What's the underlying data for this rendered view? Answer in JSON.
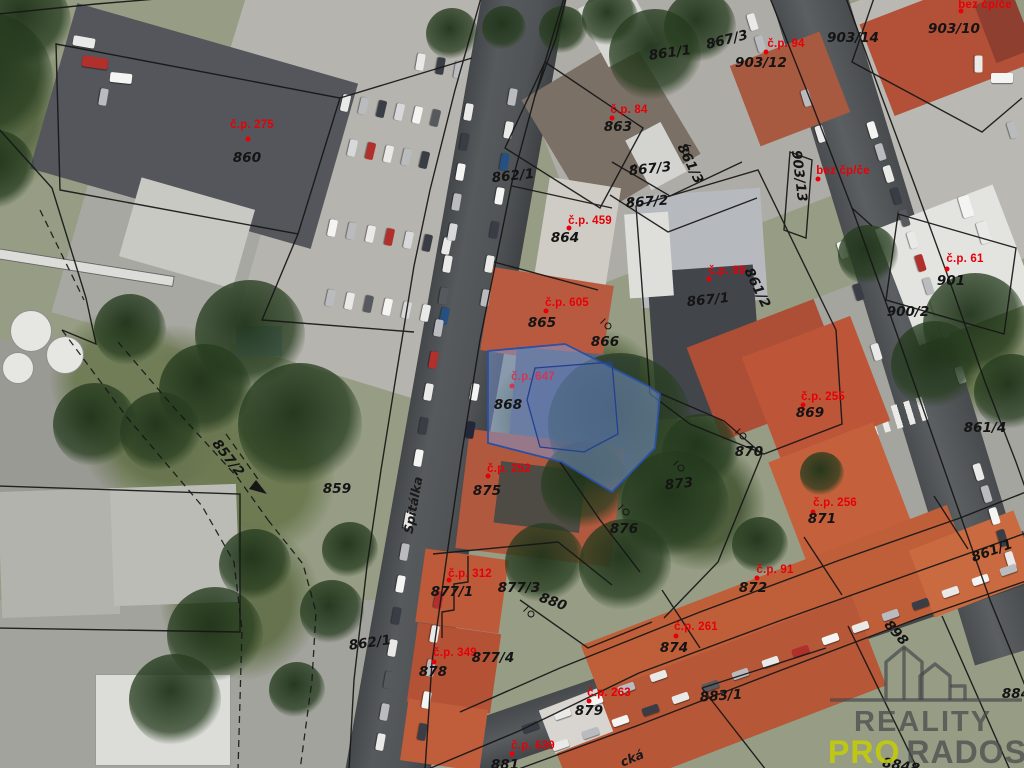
{
  "map": {
    "highlight": {
      "fill": "#7b97d3",
      "fill_opacity": 0.5,
      "stroke": "#2b50a5",
      "inner_fill": "#3c5cb0",
      "inner_fill_opacity": 0.18,
      "inner_stroke": "#23408f"
    },
    "colors": {
      "house_number_red": "#e60008",
      "parcel_black": "#141414",
      "highlight_label": "#cf3657"
    },
    "red_labels": [
      {
        "text": "č.p. 275",
        "x": 252,
        "y": 125,
        "dot_x": 248,
        "dot_y": 139
      },
      {
        "text": "č.p. 84",
        "x": 629,
        "y": 110,
        "dot_x": 612,
        "dot_y": 118
      },
      {
        "text": "č.p. 94",
        "x": 786,
        "y": 44,
        "dot_x": 766,
        "dot_y": 52
      },
      {
        "text": "bez čp/če",
        "x": 985,
        "y": 5,
        "dot_x": 961,
        "dot_y": 11
      },
      {
        "text": "bez čp/če",
        "x": 843,
        "y": 171,
        "dot_x": 818,
        "dot_y": 179
      },
      {
        "text": "č.p. 459",
        "x": 590,
        "y": 221,
        "dot_x": 569,
        "dot_y": 228
      },
      {
        "text": "č.p. 605",
        "x": 567,
        "y": 303,
        "dot_x": 546,
        "dot_y": 311
      },
      {
        "text": "č.p. 89",
        "x": 727,
        "y": 271,
        "dot_x": 709,
        "dot_y": 279
      },
      {
        "text": "č.p. 61",
        "x": 965,
        "y": 259,
        "dot_x": 947,
        "dot_y": 269
      },
      {
        "text": "č.p. 255",
        "x": 823,
        "y": 397,
        "dot_x": 803,
        "dot_y": 405
      },
      {
        "text": "č.p. 647",
        "x": 533,
        "y": 377,
        "dot_x": 512,
        "dot_y": 386,
        "color": "#cf3657"
      },
      {
        "text": "č.p. 252",
        "x": 509,
        "y": 469,
        "dot_x": 488,
        "dot_y": 476
      },
      {
        "text": "č.p. 256",
        "x": 835,
        "y": 503,
        "dot_x": 813,
        "dot_y": 512
      },
      {
        "text": "č.p. 312",
        "x": 470,
        "y": 574,
        "dot_x": 449,
        "dot_y": 580
      },
      {
        "text": "č.p. 91",
        "x": 775,
        "y": 570,
        "dot_x": 757,
        "dot_y": 578
      },
      {
        "text": "č.p. 261",
        "x": 696,
        "y": 627,
        "dot_x": 676,
        "dot_y": 636
      },
      {
        "text": "č.p. 349",
        "x": 455,
        "y": 653,
        "dot_x": 434,
        "dot_y": 662
      },
      {
        "text": "č.p. 263",
        "x": 609,
        "y": 693,
        "dot_x": 589,
        "dot_y": 701
      },
      {
        "text": "č.p. 639",
        "x": 533,
        "y": 746,
        "dot_x": 512,
        "dot_y": 754
      }
    ],
    "parcel_labels": [
      {
        "text": "860",
        "x": 247,
        "y": 158,
        "rot": 0
      },
      {
        "text": "861/1",
        "x": 670,
        "y": 53,
        "rot": -8
      },
      {
        "text": "903/12",
        "x": 761,
        "y": 63,
        "rot": 0
      },
      {
        "text": "903/14",
        "x": 853,
        "y": 38,
        "rot": 0
      },
      {
        "text": "903/10",
        "x": 954,
        "y": 29,
        "rot": 0
      },
      {
        "text": "862/1",
        "x": 513,
        "y": 176,
        "rot": -6
      },
      {
        "text": "863",
        "x": 618,
        "y": 127,
        "rot": 0
      },
      {
        "text": "867/3",
        "x": 727,
        "y": 40,
        "rot": -14
      },
      {
        "text": "867/3",
        "x": 650,
        "y": 169,
        "rot": -6
      },
      {
        "text": "867/2",
        "x": 647,
        "y": 202,
        "rot": -4
      },
      {
        "text": "864",
        "x": 565,
        "y": 238,
        "rot": 0
      },
      {
        "text": "865",
        "x": 542,
        "y": 323,
        "rot": 0
      },
      {
        "text": "866",
        "x": 605,
        "y": 342,
        "rot": 0
      },
      {
        "text": "861/3",
        "x": 690,
        "y": 164,
        "rot": 64
      },
      {
        "text": "861/2",
        "x": 757,
        "y": 288,
        "rot": 64
      },
      {
        "text": "867/1",
        "x": 708,
        "y": 300,
        "rot": -6
      },
      {
        "text": "901",
        "x": 951,
        "y": 281,
        "rot": 0
      },
      {
        "text": "900/2",
        "x": 908,
        "y": 312,
        "rot": 0
      },
      {
        "text": "903/13",
        "x": 799,
        "y": 176,
        "rot": 83
      },
      {
        "text": "869",
        "x": 810,
        "y": 413,
        "rot": 0
      },
      {
        "text": "859",
        "x": 337,
        "y": 489,
        "rot": 0
      },
      {
        "text": "857/2",
        "x": 228,
        "y": 458,
        "rot": 52
      },
      {
        "text": "868",
        "x": 508,
        "y": 405,
        "rot": 0
      },
      {
        "text": "870",
        "x": 749,
        "y": 452,
        "rot": 0
      },
      {
        "text": "873",
        "x": 679,
        "y": 484,
        "rot": -6
      },
      {
        "text": "875",
        "x": 487,
        "y": 491,
        "rot": 0
      },
      {
        "text": "876",
        "x": 624,
        "y": 529,
        "rot": 0
      },
      {
        "text": "871",
        "x": 822,
        "y": 519,
        "rot": 0
      },
      {
        "text": "861/4",
        "x": 985,
        "y": 428,
        "rot": 0
      },
      {
        "text": "861/1",
        "x": 992,
        "y": 551,
        "rot": -20
      },
      {
        "text": "872",
        "x": 753,
        "y": 588,
        "rot": 0
      },
      {
        "text": "874",
        "x": 674,
        "y": 648,
        "rot": 0
      },
      {
        "text": "877/1",
        "x": 452,
        "y": 592,
        "rot": 0
      },
      {
        "text": "877/3",
        "x": 519,
        "y": 588,
        "rot": 0
      },
      {
        "text": "880",
        "x": 553,
        "y": 602,
        "rot": 20
      },
      {
        "text": "877/4",
        "x": 493,
        "y": 658,
        "rot": 0
      },
      {
        "text": "878",
        "x": 433,
        "y": 672,
        "rot": 0
      },
      {
        "text": "879",
        "x": 589,
        "y": 711,
        "rot": 0
      },
      {
        "text": "883/1",
        "x": 721,
        "y": 696,
        "rot": -4
      },
      {
        "text": "881",
        "x": 505,
        "y": 765,
        "rot": 0
      },
      {
        "text": "862/1",
        "x": 370,
        "y": 643,
        "rot": -8
      },
      {
        "text": "898",
        "x": 896,
        "y": 633,
        "rot": 48
      },
      {
        "text": "884",
        "x": 1016,
        "y": 694,
        "rot": 0
      },
      {
        "text": "8848",
        "x": 901,
        "y": 766,
        "rot": 10
      }
    ],
    "street_labels": [
      {
        "text": "Špitálka",
        "x": 413,
        "y": 505,
        "rot": -80
      },
      {
        "text": "cká",
        "x": 632,
        "y": 758,
        "rot": -22
      }
    ],
    "symbols": [
      {
        "type": "garden",
        "x": 608,
        "y": 326,
        "rot": 0
      },
      {
        "type": "garden",
        "x": 743,
        "y": 436,
        "rot": 0
      },
      {
        "type": "garden",
        "x": 681,
        "y": 468,
        "rot": 0
      },
      {
        "type": "garden",
        "x": 626,
        "y": 512,
        "rot": 0
      },
      {
        "type": "garden",
        "x": 531,
        "y": 614,
        "rot": 0
      },
      {
        "type": "garden",
        "x": 686,
        "y": 152,
        "rot": 60
      },
      {
        "type": "check",
        "x": 714,
        "y": 45,
        "rot": -15
      },
      {
        "type": "check",
        "x": 633,
        "y": 168,
        "rot": 0
      },
      {
        "type": "check",
        "x": 631,
        "y": 202,
        "rot": 0
      }
    ]
  },
  "logo": {
    "brand_line1": "REALITY",
    "brand_accent": "PRO",
    "brand_rest": "RADOST",
    "text_color": "#45474ab8",
    "accent_color": "#c4cf00d9",
    "icon_stroke": "#45474ab0"
  }
}
